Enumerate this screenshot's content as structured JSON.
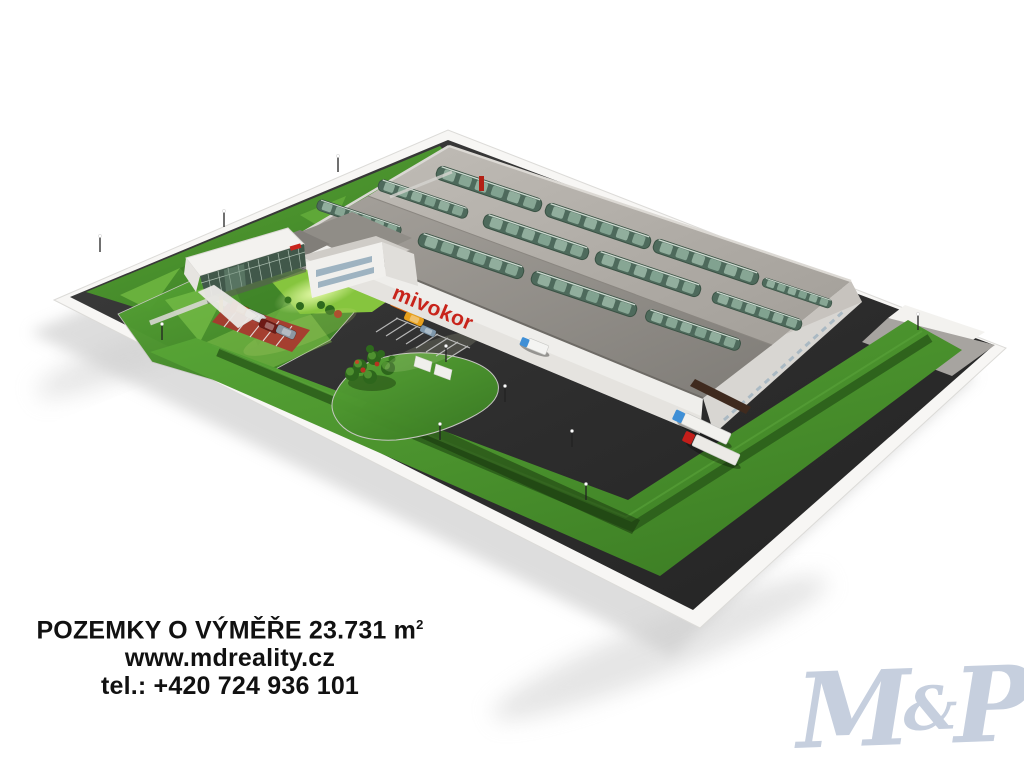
{
  "site": {
    "building_sign": "mivokor"
  },
  "footer": {
    "area_text": "POZEMKY O VÝMĚŘE 23.731 m",
    "area_sup": "2",
    "website": "www.mdreality.cz",
    "phone": "tel.: +420 724 936 101"
  },
  "watermark": {
    "m": "M",
    "amp": "&",
    "p": "P"
  },
  "colors": {
    "background": "#ffffff",
    "asphalt": "#2e2e2e",
    "grass": "#4c9830",
    "grass_hedge_dark": "#2a5c1a",
    "lawn_bright": "#9ccf3f",
    "roof_light": "#b5b1ab",
    "roof_dark": "#96928c",
    "wall_white": "#efeeeb",
    "skylight_green": "#4e6a5c",
    "sign_red": "#c8231a",
    "red_pavement": "#a8392f",
    "truck_cab_blue": "#3f8fd6",
    "truck_cab_red": "#c41e1a",
    "car_orange": "#d86a18",
    "watermark_blue": "#c6cfde",
    "text_black": "#111111"
  }
}
